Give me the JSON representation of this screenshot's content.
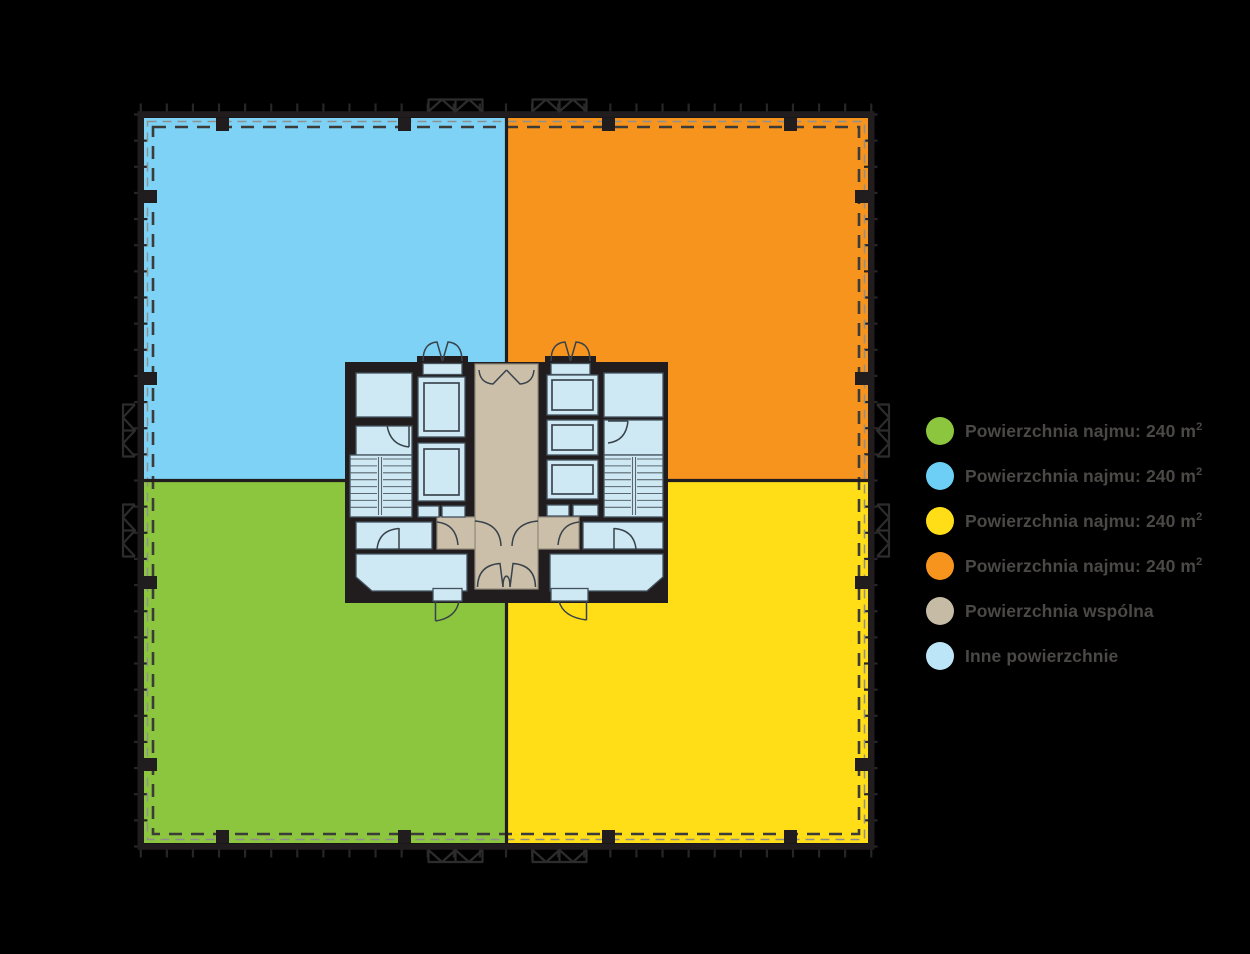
{
  "plan": {
    "colors": {
      "background": "#000000",
      "quadrant_blue": "#7DD2F6",
      "quadrant_orange": "#F7941E",
      "quadrant_green": "#8CC63E",
      "quadrant_yellow": "#FFDE17",
      "wall": "#211D1E",
      "common_area": "#CBBFA9",
      "other_area": "#CEE8F4",
      "dashed_line": "#3B3B39"
    }
  },
  "legend": {
    "items": [
      {
        "icon": "green-circle-icon",
        "color": "#8CC63E",
        "prefix": "Powierzchnia najmu: ",
        "area": "240 m",
        "sup": "2"
      },
      {
        "icon": "blue-circle-icon",
        "color": "#6DCFF6",
        "prefix": "Powierzchnia najmu: ",
        "area": "240 m",
        "sup": "2"
      },
      {
        "icon": "yellow-circle-icon",
        "color": "#FFDE17",
        "prefix": "Powierzchnia najmu: ",
        "area": "240 m",
        "sup": "2"
      },
      {
        "icon": "orange-circle-icon",
        "color": "#F7941E",
        "prefix": "Powierzchnia najmu: ",
        "area": "240 m",
        "sup": "2"
      },
      {
        "icon": "beige-circle-icon",
        "color": "#C6BBA4",
        "prefix": "Powierzchnia wspólna"
      },
      {
        "icon": "light-blue-circle-icon",
        "color": "#BCE6F7",
        "prefix": "Inne powierzchnie"
      }
    ]
  }
}
